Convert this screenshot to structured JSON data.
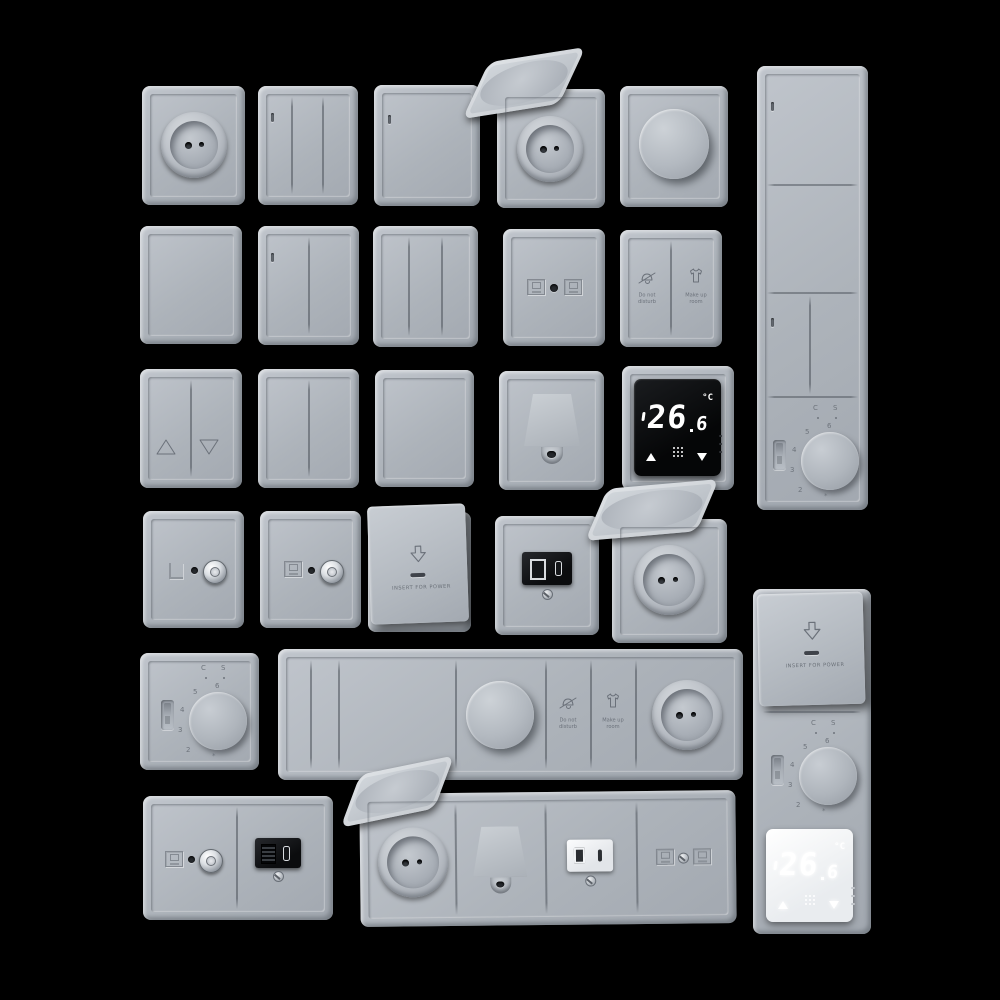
{
  "scene": {
    "background": "#000000",
    "plate_color": "#b3b9c0",
    "screen_black": "#0a0b0d",
    "screen_white": "#f2f4f6"
  },
  "labels": {
    "do_not_disturb_line1": "Do not",
    "do_not_disturb_line2": "disturb",
    "make_up_room_line1": "Make up",
    "make_up_room_line2": "room",
    "insert_for_power": "INSERT FOR POWER"
  },
  "digital_thermostat": {
    "temp_integer": "26",
    "temp_decimal": "6",
    "unit": "°C"
  },
  "dial_thermostat": {
    "marks": [
      "6",
      "5",
      "4",
      "3",
      "2"
    ],
    "frost_mark": "*",
    "mode_left": "C",
    "mode_right": "S"
  },
  "inventory": [
    "round-socket",
    "3-gang-switch",
    "1-gang-switch-with-indicator",
    "flip-lid-socket-open",
    "rotary-dimmer",
    "vertical-panel-two-switches-two-gang-and-dial-thermostat",
    "1-gang-switch",
    "2-gang-switch-with-indicator",
    "3-gang-switch",
    "twin-data-outlet",
    "do-not-disturb-make-up-room-switch",
    "shutter-switch-up-down",
    "2-gang-switch",
    "1-gang-switch",
    "cable-outlet",
    "digital-thermostat-black",
    "tv-sat-outlet-variant-l",
    "tv-sat-outlet",
    "keycard-power-switch",
    "usb-a-c-charger-black",
    "flip-lid-socket-open",
    "dial-thermostat",
    "horizontal-strip-switches-dimmer-service-buttons-socket",
    "tv-media-outlet-hdmi-usb",
    "horizontal-strip-socket-cable-usb-data",
    "vertical-panel-keycard-dial-thermostat-digital-thermostat"
  ]
}
